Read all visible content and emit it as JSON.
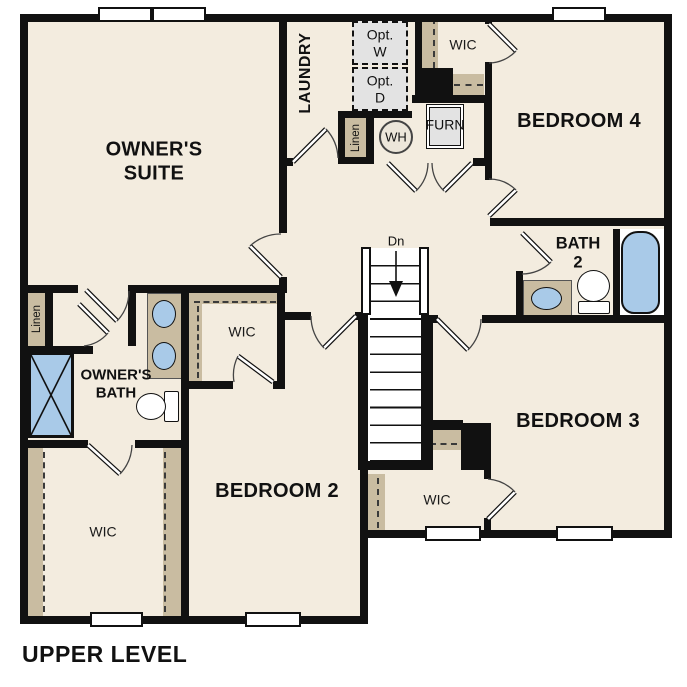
{
  "title": "UPPER LEVEL",
  "rooms": {
    "owners_suite": "OWNER'S SUITE",
    "laundry": "LAUNDRY",
    "bedroom_4": "BEDROOM 4",
    "bedroom_3": "BEDROOM 3",
    "bedroom_2": "BEDROOM 2",
    "bath_2": "BATH 2",
    "owners_bath": "OWNER'S BATH",
    "wic": "WIC",
    "linen": "Linen"
  },
  "fixtures": {
    "opt_washer": "Opt. W",
    "opt_dryer": "Opt. D",
    "water_heater": "WH",
    "furnace": "FURN",
    "stairs_down": "Dn"
  },
  "colors": {
    "wall": "#111111",
    "floor": "#f3ecdf",
    "shelf": "#c9bca1",
    "fixture_blue": "#a9cae8",
    "appliance_gray": "#e3e3e3"
  }
}
